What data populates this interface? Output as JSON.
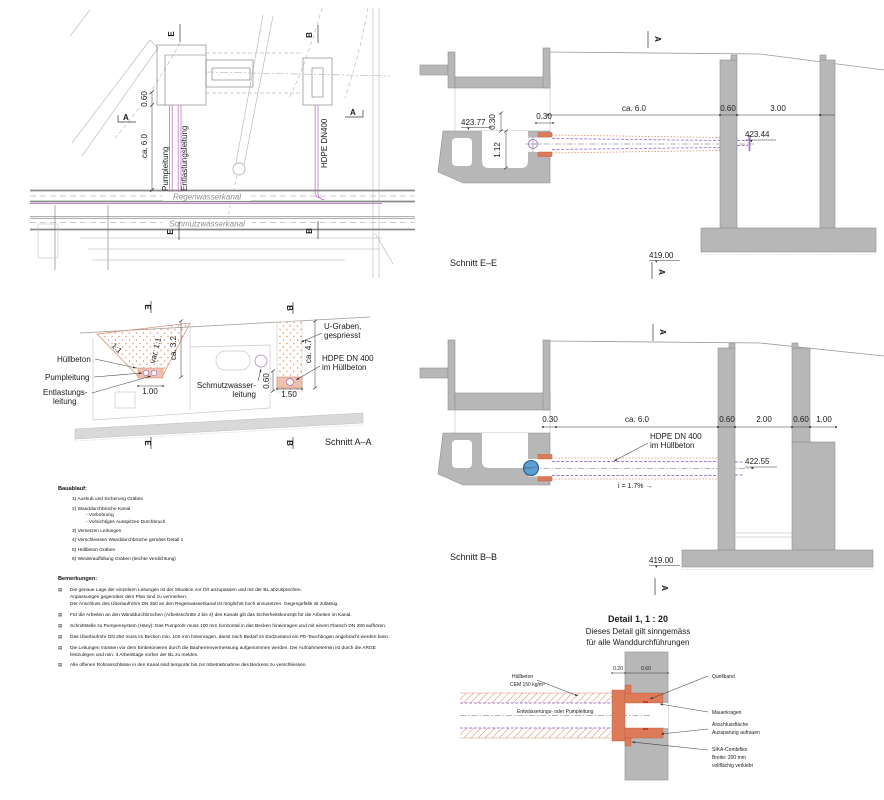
{
  "plan": {
    "marker_e": "E",
    "marker_b": "B",
    "marker_a": "A",
    "dim_060": "0.60",
    "dim_ca6": "ca. 6.0",
    "pumpleitung": "Pumpleitung",
    "entlastungsleitung": "Entlastungsleitung",
    "hdpe": "HDPE DN400",
    "regenwasserkanal": "Regenwasserkanal",
    "schmutzwasserkanal": "Schmutzwasserkanal"
  },
  "schnitt_ee": {
    "title": "Schnitt E–E",
    "marker": "A",
    "lvl_left": "423.77",
    "d030v": "0.30",
    "d030h": "0.30",
    "d112": "1.12",
    "ca6": "ca. 6.0",
    "d060": "0.60",
    "d300": "3.00",
    "lvl_pipe": "423.44",
    "lvl_base": "419.00"
  },
  "schnitt_aa": {
    "title": "Schnitt A–A",
    "marker_e": "E",
    "marker_b": "B",
    "huellbeton": "Hüllbeton",
    "pumpleitung": "Pumpleitung",
    "entlastung1": "Entlastungs-",
    "entlastung2": "leitung",
    "slope1": "1:1",
    "slope2": "var. 1:1",
    "ca32": "ca. 3.2",
    "d100": "1.00",
    "schmutz1": "Schmutzwasser-",
    "schmutz2": "leitung",
    "d060": "0.60",
    "d150": "1.50",
    "ca47": "ca. 4.7",
    "ugraben1": "U-Graben,",
    "ugraben2": "gespriesst",
    "hdpe1": "HDPE DN 400",
    "hdpe2": "im Hüllbeton"
  },
  "schnitt_bb": {
    "title": "Schnitt B–B",
    "marker": "A",
    "d030": "0.30",
    "ca6": "ca. 6.0",
    "d060a": "0.60",
    "d200": "2.00",
    "d060b": "0.60",
    "d100": "1.00",
    "hdpe1": "HDPE DN 400",
    "hdpe2": "im Hüllbeton",
    "lvl_pipe": "422.55",
    "slope": "i = 1.7% →",
    "lvl_base": "419.00"
  },
  "bauablauf": {
    "heading": "Bauablauf:",
    "items": [
      {
        "t": "1) Aushub und Sicherung Gräben"
      },
      {
        "t": "2) Wanddurchbrüche Kanal"
      },
      {
        "t": "- Vorbohrung"
      },
      {
        "t": "- Vorsichtiges Ausspitzen Durchbruch"
      },
      {
        "t": "3) Versetzen Leitungen"
      },
      {
        "t": "4) Verschliessen Wanddurchbrüche gemäss Detail 1"
      },
      {
        "t": "5) Hüllbeton Gräben"
      },
      {
        "t": "6) Wiederauffüllung Gräben (leichte Verdichtung)"
      }
    ]
  },
  "bemerkungen": {
    "heading": "Bemerkungen:",
    "bullet": "▤",
    "items": [
      {
        "t": "Die genaue Lage der einzelnen Leitungen ist der Situation vor Ort anzupassen und mit der BL abzusprechen.\nAnpassungen gegenüber dem Plan sind zu vermerken.\nDer Anschluss des Überlaufrohrs DN 250 an den Regenwasserkanal ist möglichst hoch anzusetzen. Gegengefälle ist zulässig."
      },
      {
        "t": "Für die Arbeiten an den Wanddurchbrüchen (Arbeitsschritte 2 bis 4) des Kanals gilt das Sicherheitskonzept für die Arbeiten im Kanal."
      },
      {
        "t": "Schnittstelle zu Pumpensystem (Häny): Das Pumprohr muss 100 mm horizontal in das Becken hineinragen und mit einem Flansch DN 280 aufhören."
      },
      {
        "t": "Das Überlaufrohr DN 250 muss im Becken min. 100 mm hineinragen, damit nach Bedarf im Endzustand ein PE-Tauchbogen angebracht werden kann."
      },
      {
        "t": "Die Leitungen müssen vor dem Einbetonieren durch die Bauherrenvermessung aufgenommen werden. Der Aufnahmetermin ist durch die ARGE festzulegen und min. 3 Arbeitstage vorher der BL zu melden."
      },
      {
        "t": "Alle offenen Rohranschlüsse in den Kanal sind temporär bis zur Inbetriebnahme des Beckens zu verschliessen."
      }
    ]
  },
  "detail": {
    "title": "Detail 1,  1 : 20",
    "subtitle1": "Dieses Detail gilt sinngemäss",
    "subtitle2": "für alle Wanddurchführungen",
    "marker": "A",
    "huellbeton1": "Hüllbeton",
    "huellbeton2": "CEM 150 kg/m³",
    "leitung": "Entwässerungs- oder Pumpleitung",
    "d020": "0.20",
    "d060": "0.60",
    "quellband": "Quellband",
    "mauerkragen": "Mauerkragen",
    "anschluss1": "Anschlussfläche",
    "anschluss2": "Aussparung aufrauen",
    "sika1": "SIKA-Combiflex",
    "sika2": "Breite: 200 mm",
    "sika3": "vollflächig verklebt"
  },
  "colors": {
    "concrete": "#b7b7b7",
    "pipe_magenta": "#c585cf",
    "pipe_purple": "#a878c8",
    "huellbeton_salmon": "#dd7a58",
    "pump_blue": "#5b9fd4",
    "line_dark": "#555555",
    "line_light": "#c8c8c8"
  }
}
